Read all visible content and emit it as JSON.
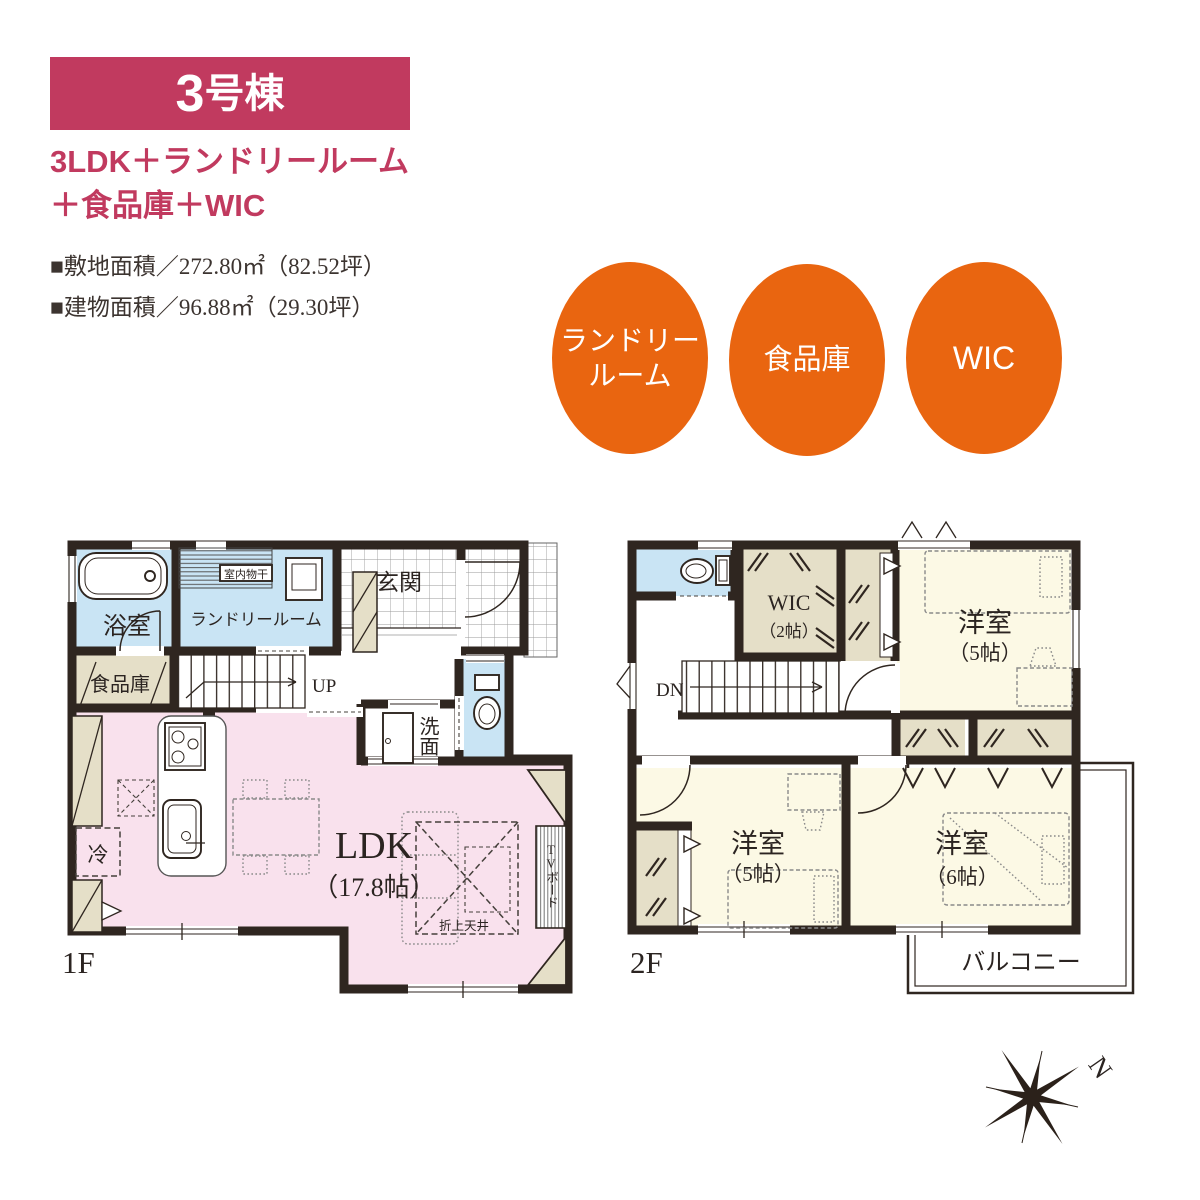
{
  "header": {
    "banner_number": "3",
    "banner_suffix": "号棟",
    "title_line1": "3LDK＋ランドリールーム",
    "title_line2": "＋食品庫＋WIC",
    "site_area": "■敷地面積／272.80㎡（82.52坪）",
    "building_area": "■建物面積／96.88㎡（29.30坪）",
    "accent_color": "#c13a5f"
  },
  "badges": {
    "color": "#e96510",
    "items": [
      {
        "line1": "ランドリー",
        "line2": "ルーム"
      },
      {
        "label": "食品庫"
      },
      {
        "label": "WIC"
      }
    ]
  },
  "floor1": {
    "label": "1F",
    "rooms": {
      "bath": "浴室",
      "laundry": "ランドリールーム",
      "indoor_drying": "室内物干",
      "entrance": "玄関",
      "pantry": "食品庫",
      "stairs": "UP",
      "washroom": "洗面",
      "ldk_name": "LDK",
      "ldk_size": "（17.8帖）",
      "fridge": "冷",
      "coffered_ceiling": "折上天井",
      "tv_board": "TVボード"
    }
  },
  "floor2": {
    "label": "2F",
    "rooms": {
      "wic_name": "WIC",
      "wic_size": "（2帖）",
      "stairs": "DN",
      "bedroom_a_name": "洋室",
      "bedroom_a_size": "（5帖）",
      "bedroom_b_name": "洋室",
      "bedroom_b_size": "（5帖）",
      "bedroom_c_name": "洋室",
      "bedroom_c_size": "（6帖）",
      "balcony": "バルコニー"
    }
  },
  "compass": {
    "north_label": "N"
  },
  "palette": {
    "wall": "#2f2620",
    "water_room": "#c9e4f4",
    "ldk_pink": "#f9e1ed",
    "closet_beige": "#e5dfc8",
    "bedroom_cream": "#fcf9e5"
  }
}
